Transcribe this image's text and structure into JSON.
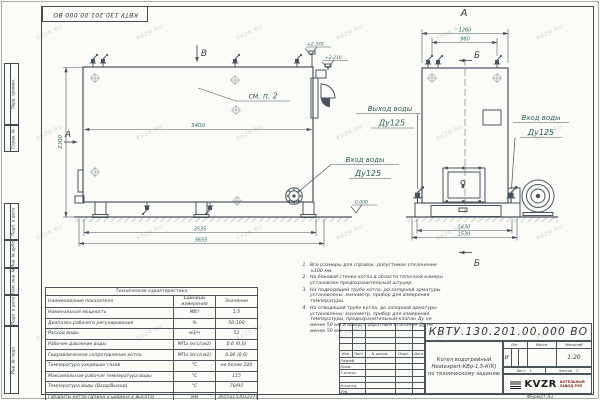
{
  "watermark": "KVZR.RU",
  "corner_designation": "КВТУ.130.201.00.000  ВО",
  "side_stamps": [
    "Перв. примен.",
    "Справ. №",
    "Подп. и дата",
    "Инв. № дубл.",
    "Взам. инв. №",
    "Подп. и дата",
    "Инв. № подл."
  ],
  "left_view": {
    "mark_b": "В",
    "mark_a": "А",
    "see_note": "см. п. 2",
    "dim_length": "3400",
    "dim_height": "2300",
    "dim_base": "3535",
    "dim_overall": "3655",
    "elev_top": "+2.370",
    "elev_mid": "+2.210",
    "elev_zero": "0.000",
    "inlet_label": "Вход воды",
    "inlet_dn": "Ду125"
  },
  "right_view": {
    "title": "А",
    "section": "Б",
    "dim_top_outer": "1260",
    "dim_top_inner": "960",
    "dim_bottom_inner": "1430",
    "dim_bottom_outer": "1530",
    "outlet_label": "Выход воды",
    "outlet_dn": "Ду125",
    "inlet_label": "Вход воды",
    "inlet_dn": "Ду125"
  },
  "notes": {
    "items": [
      {
        "n": "1.",
        "text": "Все размеры для справок, допустимое отклонение ±100 мм."
      },
      {
        "n": "2.",
        "text": "На боковой стенке котла в области топочной камеры установлен предохранительный штуцер."
      },
      {
        "n": "3.",
        "text": "На подводящей трубе котла, до запорной арматуры установлены: манометр, прибор для измерения температуры."
      },
      {
        "n": "4.",
        "text": "На отводящей трубе котла, до запорной арматуры установлены: манометр, прибор для измерения температуры, предохранительный клапан Ду не менее 50 мм и обвод с обратным клапаном Ду не менее 50 мм."
      }
    ]
  },
  "tech_table": {
    "title": "Техническая характеристика",
    "headers": [
      "Наименование показателя",
      "Единицы измерения",
      "Значение"
    ],
    "rows": [
      [
        "Номинальная мощность",
        "МВт",
        "1,5"
      ],
      [
        "Диапазон рабочего регулирования",
        "%",
        "50-100"
      ],
      [
        "Расход воды",
        "м3/ч",
        "52"
      ],
      [
        "Рабочее давление воды",
        "МПа (кгс/см2)",
        "0,6 (6,0)"
      ],
      [
        "Гидравлическое сопротивление котла",
        "МПа (кгс/см2)",
        "0,06 (0,6)"
      ],
      [
        "Температура уходящих газов",
        "°С",
        "не более 220"
      ],
      [
        "Максимальная рабочая температура воды",
        "°С",
        "115"
      ],
      [
        "Температура воды (Вход/Выход)",
        "°С",
        "70/95"
      ],
      [
        "Габариты котла (Длина х ширина х высота)",
        "мм",
        "3655х1530х2370"
      ]
    ]
  },
  "title_block": {
    "designation": "КВТУ.130.201.00.000  ВО",
    "product_line1": "Котел водогрейный",
    "product_line2": "Heatexpert-КВр-1,5-К(К)",
    "product_line3": "по техническому заданию",
    "change_cols": [
      "Изм",
      "Лист",
      "N докум.",
      "Подп.",
      "Дата"
    ],
    "sign_rows": [
      "Разраб.",
      "Пров.",
      "Т.контр.",
      "",
      "Н.контр.",
      "Утв."
    ],
    "lit_header": "Лит.",
    "mass_header": "Масса",
    "scale_header": "Масштаб",
    "lit_value": "И",
    "scale_value": "1:20",
    "sheet_label": "Лист",
    "sheet_value": "1",
    "sheets_label": "Листов",
    "sheets_value": "2",
    "logo": "KVZR",
    "logo_caption1": "КОТЕЛЬНЫЙ",
    "logo_caption2": "ЗАВОД РЭП",
    "format": "Формат  А3"
  }
}
